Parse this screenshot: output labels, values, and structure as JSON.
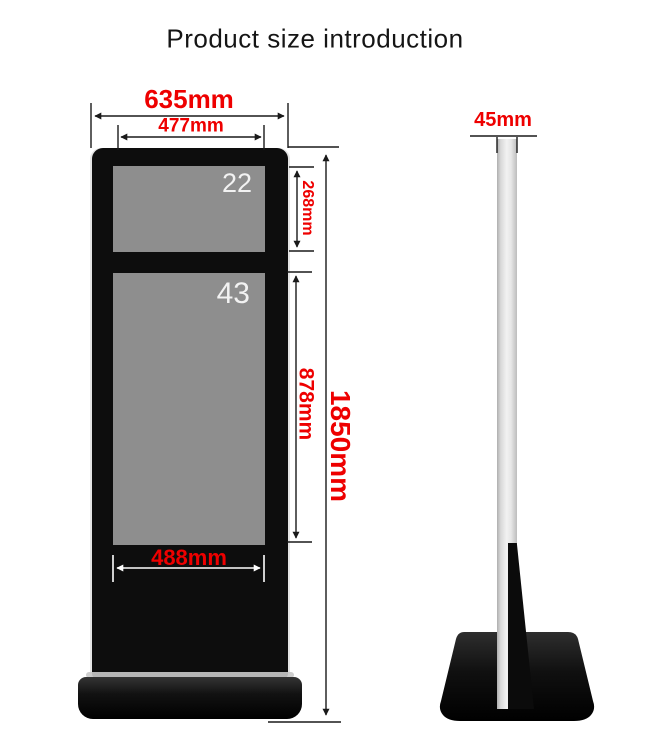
{
  "title": "Product size introduction",
  "front_view": {
    "overall_width": "635mm",
    "screen_width": "477mm",
    "top_screen": {
      "size": "22",
      "height": "268mm"
    },
    "main_screen": {
      "size": "43",
      "height": "878mm"
    },
    "lower_width": "488mm",
    "total_height": "1850mm"
  },
  "side_view": {
    "thickness": "45mm"
  },
  "colors": {
    "dimension_text": "#ee0000",
    "annotation_line": "#1a1a1a",
    "kiosk_body": "#0d0d0d",
    "screen_fill": "#8e8e8e",
    "screen_label": "#f2f2f2",
    "inner_dimension_line": "#ffffff",
    "side_column": "#e0e0e0"
  }
}
